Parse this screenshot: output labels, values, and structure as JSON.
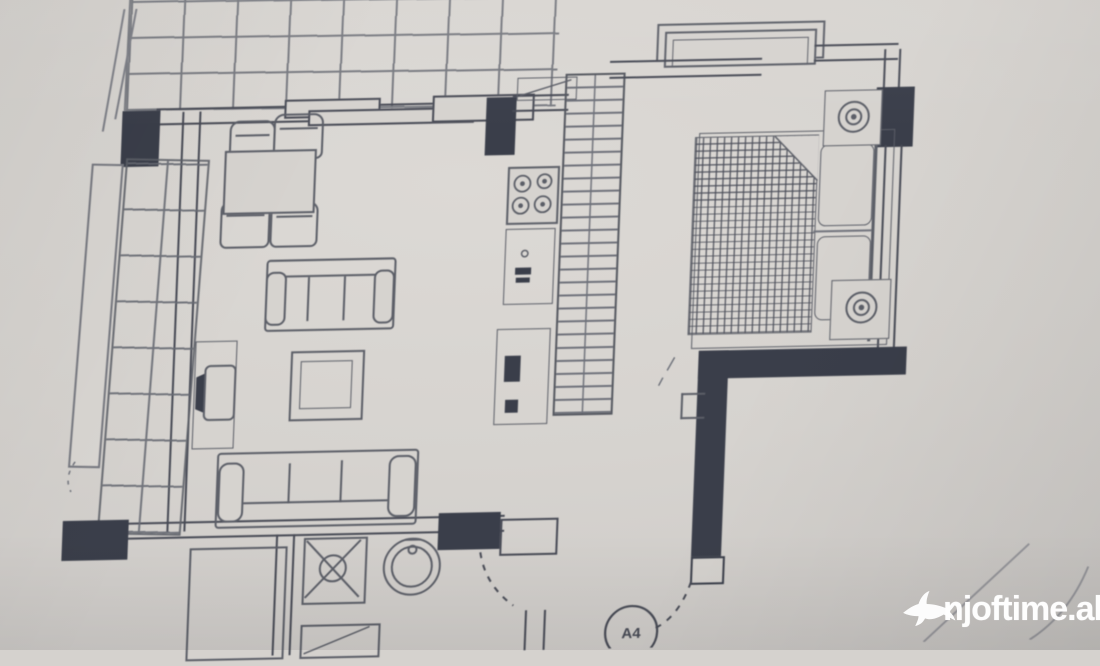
{
  "watermark": {
    "text": "njoftime.al",
    "logo_icon": "swallow-bird-logo",
    "color": "#ffffff"
  },
  "plan": {
    "unit_circle_label": "A4"
  },
  "palette": {
    "paper": "#d6d3cf",
    "ink": "#474a55",
    "furniture_line": "#5b5e67",
    "wall_fill": "#3a3e4a",
    "grid_line": "#666972"
  }
}
